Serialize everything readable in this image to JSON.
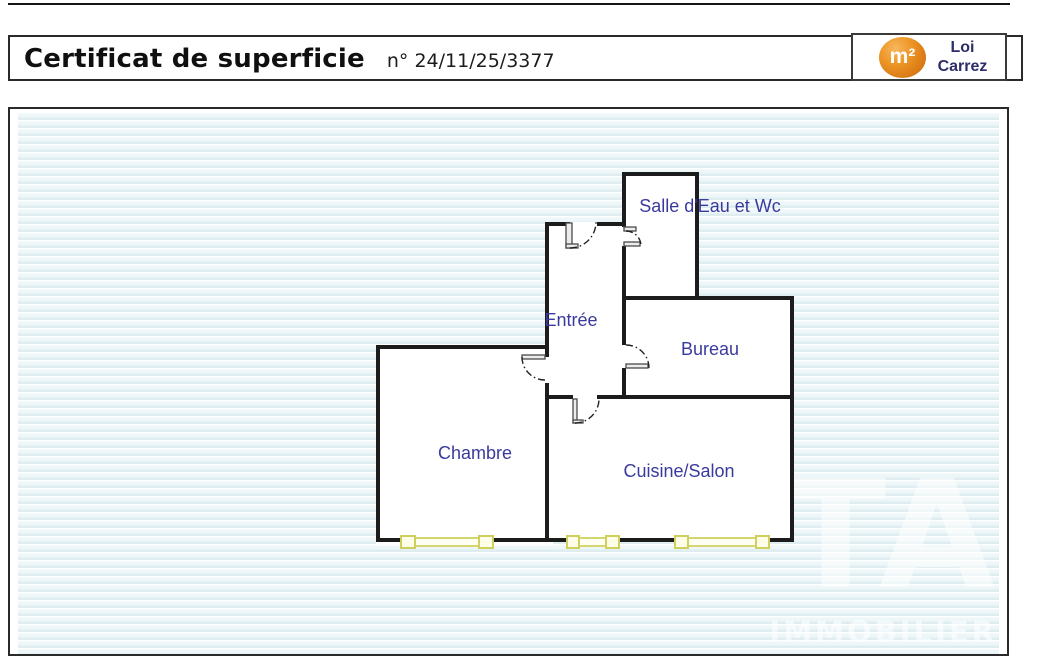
{
  "header": {
    "title": "Certificat de superficie",
    "certificate_number": "n° 24/11/25/3377",
    "logo": {
      "symbol": "m²",
      "line1": "Loi",
      "line2": "Carrez"
    }
  },
  "plan": {
    "rooms": [
      {
        "label": "Salle d'Eau et Wc"
      },
      {
        "label": "Entrée"
      },
      {
        "label": "Bureau"
      },
      {
        "label": "Chambre"
      },
      {
        "label": "Cuisine/Salon"
      }
    ],
    "watermark_large": "TA",
    "watermark_small": "IMMOBILIER"
  },
  "colors": {
    "room_label": "#3a3a9e",
    "logo_text": "#2d2d6b",
    "logo_orange": "#e5891f",
    "wall": "#1c1c1c",
    "window": "#d6d670",
    "stripe": "#dfedf1"
  }
}
